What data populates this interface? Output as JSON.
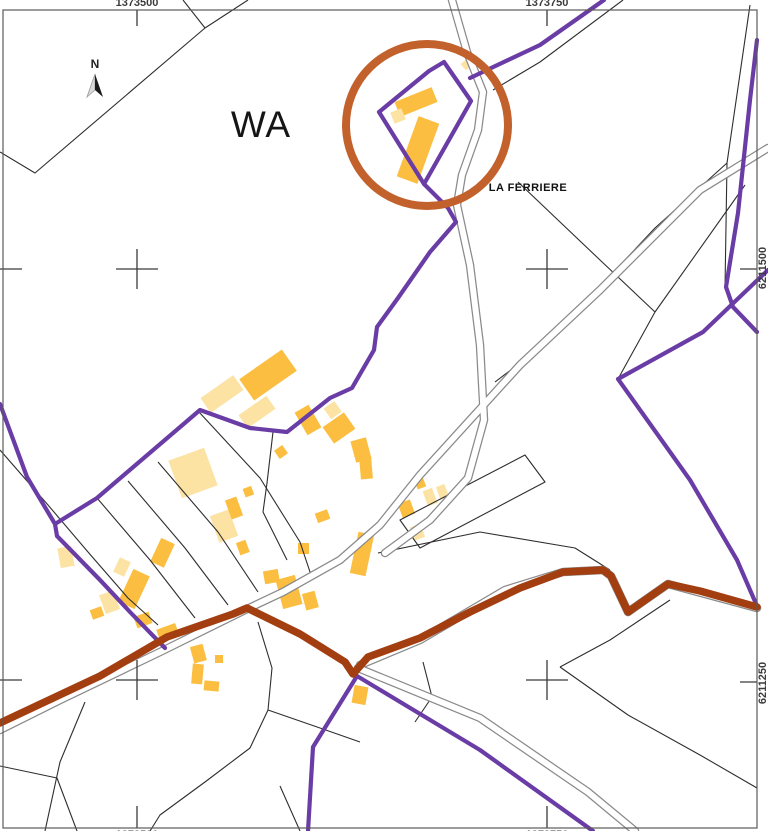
{
  "map": {
    "region_label": "WA",
    "place_label": "LA FERRIERE",
    "north_label": "N",
    "coordinates": {
      "x_west": "1373500",
      "x_east": "1373750",
      "y_north": "6211500",
      "y_south": "6211250"
    }
  },
  "colors": {
    "purple": "#6A3CA5",
    "brown": "#A33E11",
    "circle": "#C2612C",
    "building_dark": "#FBBE41",
    "building_light": "#FCE3A4",
    "parcel_line": "#2E2E2E",
    "road_casing": "#8A8A8A",
    "frame": "#5A5A5A"
  }
}
